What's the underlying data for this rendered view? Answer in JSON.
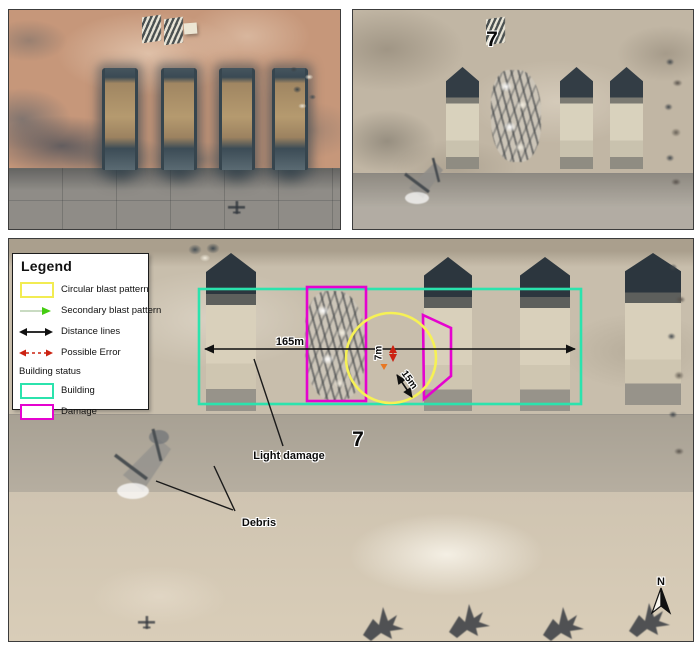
{
  "figure": {
    "legend": {
      "title": "Legend",
      "items": [
        {
          "label": "Circular blast pattern",
          "color": "#f2ec52"
        },
        {
          "label": "Secondary blast pattern",
          "color": "#44cc11"
        },
        {
          "label": "Distance lines",
          "color": "#111111"
        },
        {
          "label": "Possible Error",
          "color": "#cc2211"
        }
      ],
      "group_label": "Building status",
      "status_items": [
        {
          "label": "Building",
          "color": "#2be3ad"
        },
        {
          "label": "Damage",
          "color": "#e503cf"
        }
      ]
    },
    "annotations": {
      "main_distance": "165m",
      "error_distance": "7m",
      "crater_distance": "15m",
      "light_damage": "Light damage",
      "debris": "Debris",
      "building_number_bottom": "7",
      "building_number_top": "7",
      "north": "N"
    },
    "colors": {
      "circular_blast": "#f6f155",
      "secondary_blast": "#44cc11",
      "distance_line": "#111111",
      "possible_error": "#cc2211",
      "building": "#2be3ad",
      "damage": "#e503cf",
      "error_marker_orange": "#e87722"
    }
  }
}
